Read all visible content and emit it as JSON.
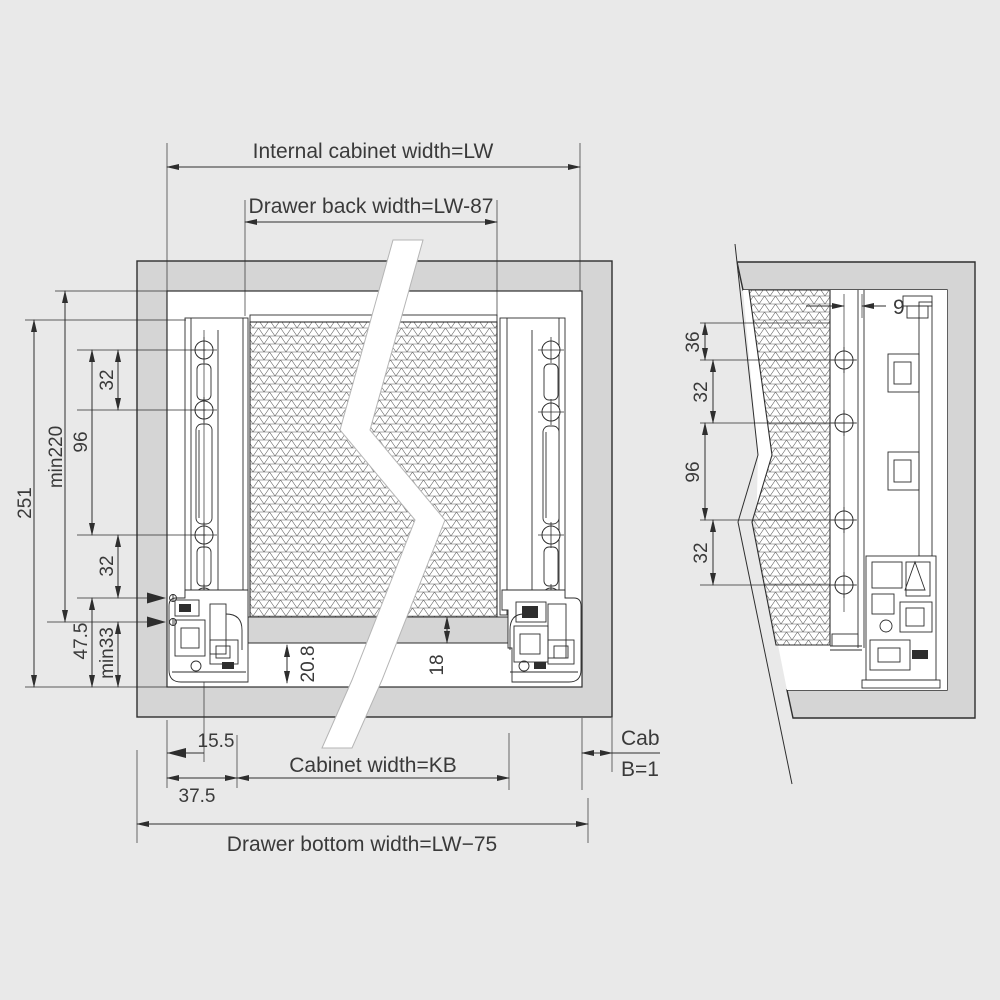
{
  "colors": {
    "background": "#e9e9e9",
    "panel_gray": "#d5d5d5",
    "line": "#2e2e2e",
    "text": "#3a3a3a",
    "white": "#ffffff",
    "break_edge": "#b5b5b5"
  },
  "main_view": {
    "top_dims": {
      "internal_cabinet_width": "Internal cabinet width=LW",
      "drawer_back_width": "Drawer back width=LW-87"
    },
    "left_dims": {
      "total": "251",
      "min_top": "min220",
      "pitch_32_top": "32",
      "pitch_96": "96",
      "pitch_32_bottom": "32",
      "offset_47_5": "47.5",
      "min_bottom": "min33"
    },
    "inner_dims": {
      "bottom_recess": "20.8",
      "bottom_thickness": "18"
    },
    "bottom_dims": {
      "offset_15_5": "15.5",
      "offset_37_5": "37.5",
      "cabinet_width": "Cabinet width=KB",
      "drawer_bottom_width": "Drawer bottom width=LW−75"
    },
    "side_note": {
      "line1": "Cabinet side",
      "line2": "B=16"
    }
  },
  "side_view": {
    "dims": {
      "setback_9": "9",
      "top_36": "36",
      "pitch_32_top": "32",
      "pitch_96": "96",
      "pitch_32_bottom": "32"
    }
  }
}
